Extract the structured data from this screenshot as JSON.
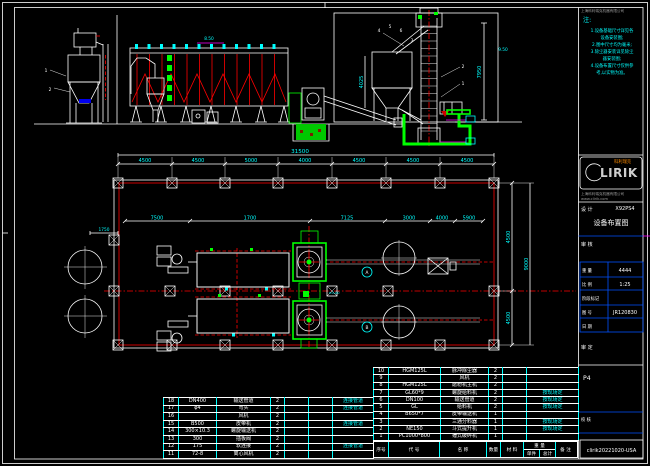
{
  "notes": {
    "heading": "注:",
    "lines": [
      "1.设备基础尺寸详见各",
      "设备安装图;",
      "2.图中尺寸均为毫米;",
      "3.除尘器安装详见除尘",
      "器安装图;",
      "4.设备布置尺寸仅供参",
      "考,以实物为准。"
    ]
  },
  "logo": {
    "brand": "LIRIK",
    "brand_cn": "科利瑞克",
    "company": "上海科利瑞克机器有限公司",
    "website": "www.clirik.com"
  },
  "titleblock": {
    "company_top": "上海科利瑞克机器有限公司",
    "design_label": "设 计",
    "project": "X92PS4",
    "drawing_title": "设备布置图",
    "check_label": "审 核",
    "weight_label": "重 量",
    "weight": "4444",
    "scale_label": "比 例",
    "scale": "1:25",
    "stage_label": "阶段标记",
    "drawno_label": "图 号",
    "drawno": "JR120830",
    "date_label": "日 期",
    "approve_label": "审 定",
    "sheet": "P4",
    "proof_label": "校 核",
    "footer": "clirik20221020-USA"
  },
  "elevation": {
    "height_dim": "7950",
    "hopper_dim": "4025",
    "level_left": "8.50",
    "level_right": "9.50",
    "callouts": [
      "1",
      "2",
      "3",
      "4",
      "5",
      "6"
    ]
  },
  "plan": {
    "overall_dim": "31500",
    "bay_dims": [
      "4500",
      "4500",
      "5000",
      "4000",
      "4500",
      "4500",
      "4500"
    ],
    "inner_dims": [
      "7500",
      "1700",
      "7125",
      "3000",
      "4000",
      "5900"
    ],
    "right_dims": [
      "4500",
      "4500",
      "9000"
    ],
    "left_dim": "1750",
    "bubble_a": "A",
    "bubble_b": "B",
    "center_label": "±0.00"
  },
  "bom": {
    "header": [
      "序号",
      "代  号",
      "名  称",
      "数量",
      "材 料",
      "重 量",
      "单件",
      "总计",
      "备 注"
    ],
    "left_rows": [
      [
        "18",
        "DN400",
        "输送管道",
        "2",
        "",
        "",
        "连接管道"
      ],
      [
        "17",
        "φ4",
        "弯头",
        "2",
        "",
        "",
        "连接管道"
      ],
      [
        "16",
        "",
        "风机",
        "2",
        "",
        "",
        ""
      ],
      [
        "15",
        "B500",
        "皮带机",
        "2",
        "",
        "",
        "连接管道"
      ],
      [
        "14",
        "300×10.3",
        "螺旋输送机",
        "2",
        "",
        "",
        ""
      ],
      [
        "13",
        "300",
        "插板阀",
        "2",
        "",
        "",
        ""
      ],
      [
        "12",
        "175",
        "软连接",
        "2",
        "",
        "",
        "连接管道"
      ],
      [
        "11",
        "72-8",
        "离心风机",
        "2",
        "",
        "",
        ""
      ]
    ],
    "right_rows": [
      [
        "10",
        "HGM125L",
        "脉冲除尘器",
        "2",
        "",
        ""
      ],
      [
        "9",
        "",
        "风机",
        "2",
        "",
        ""
      ],
      [
        "8",
        "HGM125L",
        "磨粉机主机",
        "2",
        "",
        ""
      ],
      [
        "7",
        "GL60*9",
        "螺旋给料机",
        "2",
        "",
        "按现场定"
      ],
      [
        "6",
        "DN100",
        "输送管道",
        "2",
        "",
        "按现场定"
      ],
      [
        "5",
        "GL",
        "给料机",
        "2",
        "",
        "按现场定"
      ],
      [
        "4",
        "B650*7",
        "皮带输送机",
        "1",
        "",
        ""
      ],
      [
        "3",
        "",
        "三通分料器",
        "1",
        "",
        "按现场定"
      ],
      [
        "2",
        "NE150",
        "斗式提升机",
        "1",
        "",
        "按现场定"
      ],
      [
        "1",
        "PC1000*800",
        "锤式破碎机",
        "1",
        "",
        ""
      ]
    ]
  }
}
